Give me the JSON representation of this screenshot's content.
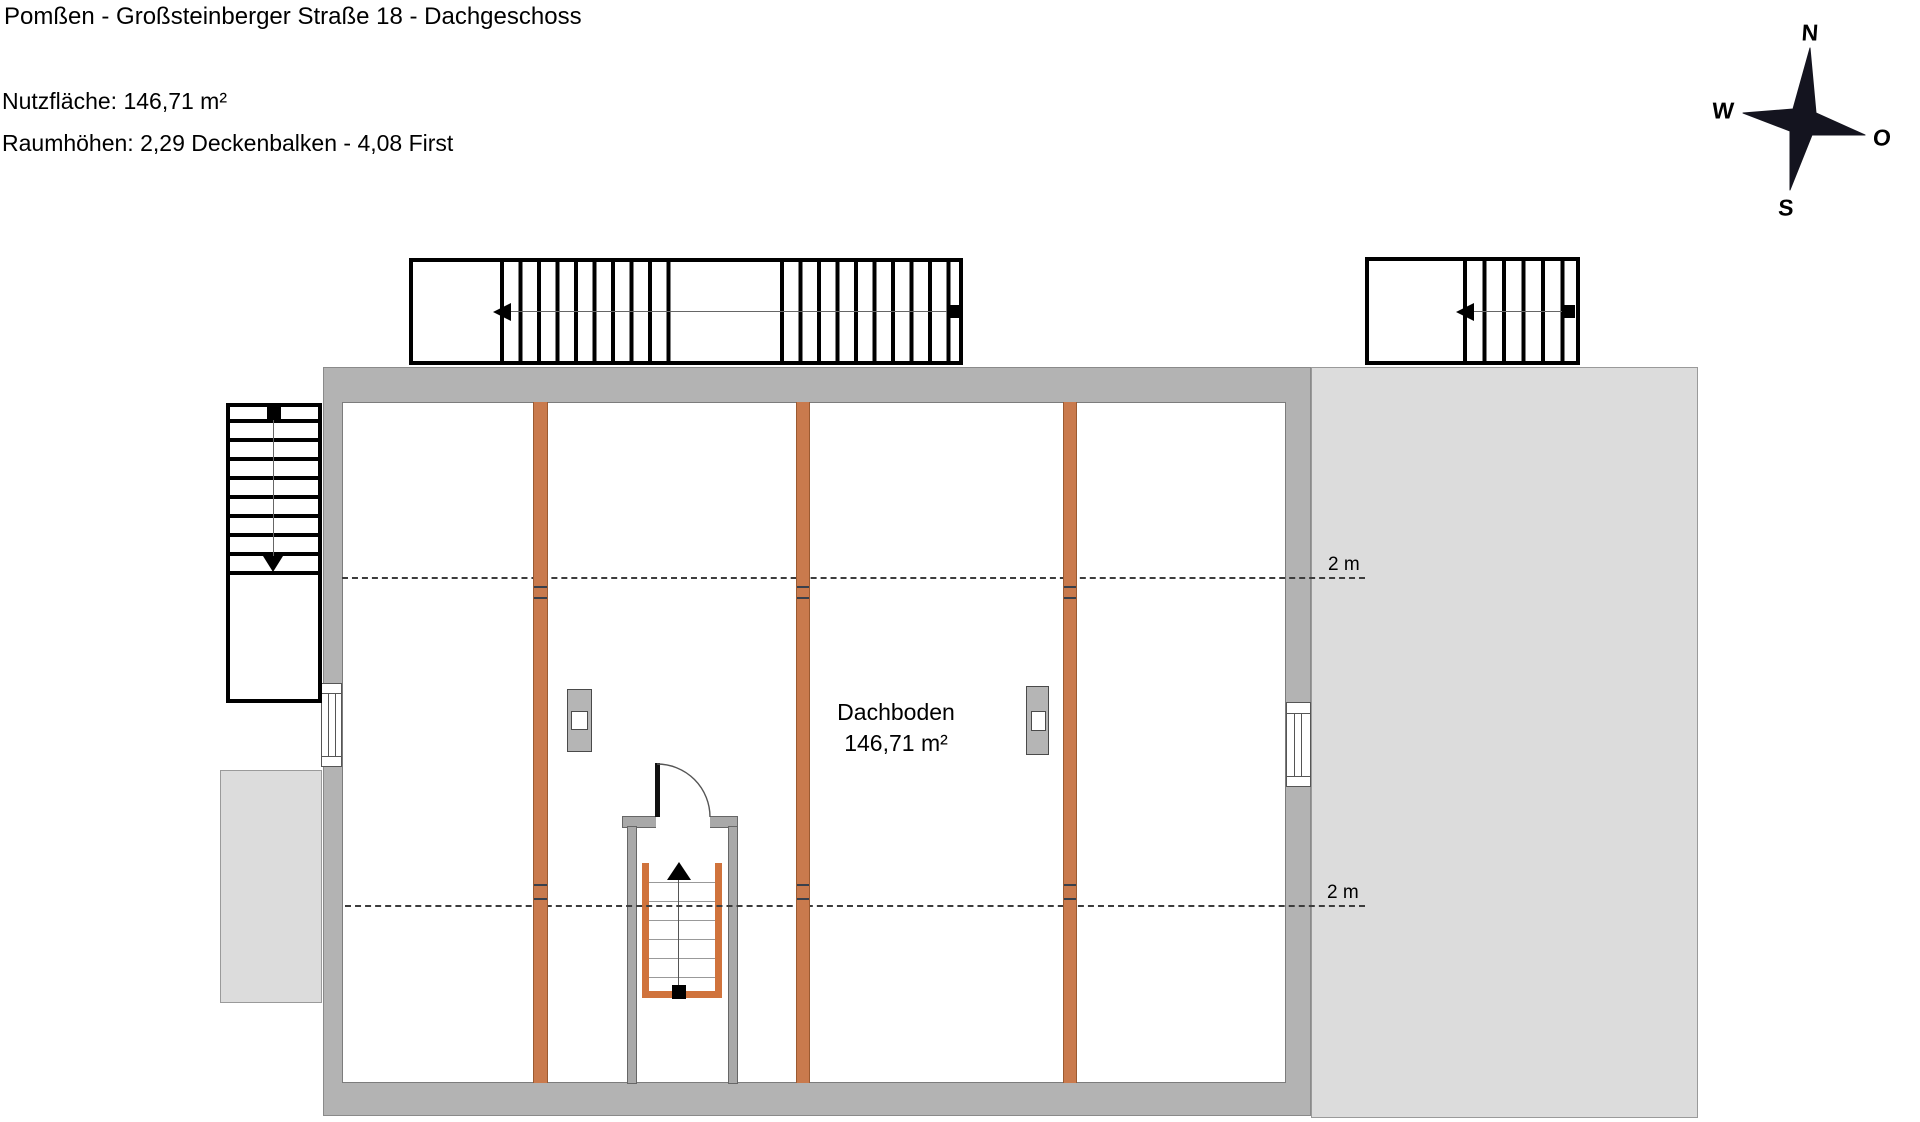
{
  "header": {
    "title": "Pomßen - Großsteinberger Straße 18 - Dachgeschoss",
    "area_line": "Nutzfläche: 146,71 m²",
    "heights_line": "Raumhöhen: 2,29 Deckenbalken - 4,08 First"
  },
  "compass": {
    "north": "N",
    "west": "W",
    "east": "O",
    "south": "S"
  },
  "room": {
    "name": "Dachboden",
    "area": "146,71 m²"
  },
  "dimensions": {
    "upper_label": "2 m",
    "lower_label": "2 m"
  },
  "colors": {
    "wall": "#b3b3b3",
    "roof_area": "#dcdcdc",
    "beam": "#c97a4d",
    "stair_accent": "#d0733c",
    "outline": "#000000"
  }
}
